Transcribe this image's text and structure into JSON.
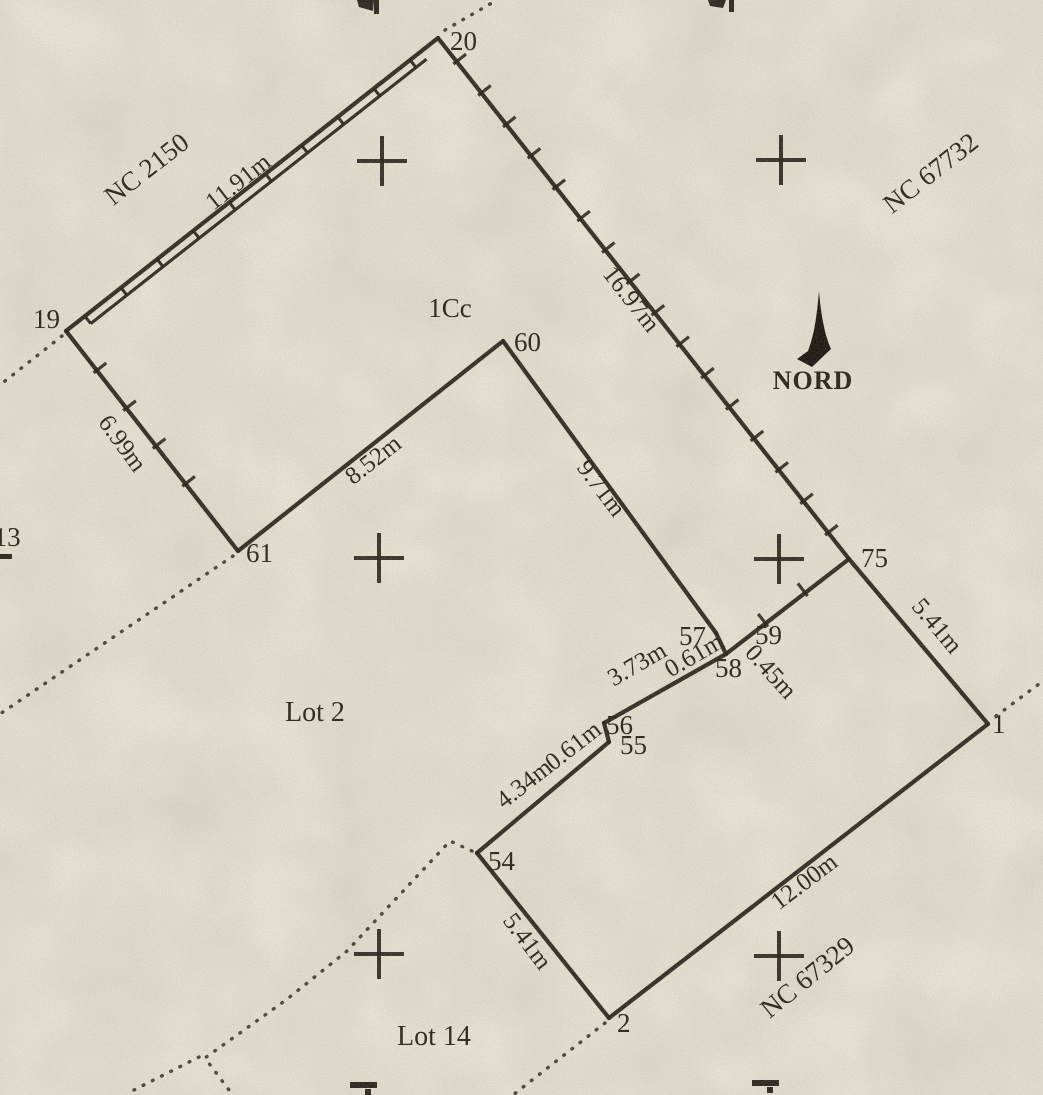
{
  "colors": {
    "paper": "#e9e5d7",
    "ink": "#241f18"
  },
  "plan": {
    "north_label": "NORD",
    "points": [
      {
        "id": "19",
        "x": 66,
        "y": 331,
        "lx": 33,
        "ly": 328
      },
      {
        "id": "20",
        "x": 438,
        "y": 38,
        "lx": 450,
        "ly": 50
      },
      {
        "id": "60",
        "x": 503,
        "y": 341,
        "lx": 514,
        "ly": 351
      },
      {
        "id": "61",
        "x": 238,
        "y": 551,
        "lx": 246,
        "ly": 562
      },
      {
        "id": "75",
        "x": 849,
        "y": 559,
        "lx": 861,
        "ly": 567
      },
      {
        "id": "59",
        "x": 740,
        "y": 640,
        "lx": 755,
        "ly": 644
      },
      {
        "id": "58",
        "x": 726,
        "y": 654,
        "lx": 715,
        "ly": 677
      },
      {
        "id": "57",
        "x": 716,
        "y": 633,
        "lx": 679,
        "ly": 645
      },
      {
        "id": "56",
        "x": 604,
        "y": 723,
        "lx": 606,
        "ly": 734
      },
      {
        "id": "55",
        "x": 609,
        "y": 742,
        "lx": 620,
        "ly": 754
      },
      {
        "id": "54",
        "x": 477,
        "y": 853,
        "lx": 488,
        "ly": 870
      },
      {
        "id": "2",
        "x": 609,
        "y": 1018,
        "lx": 617,
        "ly": 1032
      },
      {
        "id": "1",
        "x": 988,
        "y": 724,
        "lx": 992,
        "ly": 733
      }
    ],
    "edges": [
      {
        "from": "19",
        "to": "20",
        "style": "ladder"
      },
      {
        "from": "20",
        "to": "75",
        "style": "solid"
      },
      {
        "from": "19",
        "to": "61",
        "style": "solid"
      },
      {
        "from": "61",
        "to": "60",
        "style": "solid"
      },
      {
        "from": "60",
        "to": "57",
        "style": "solid"
      },
      {
        "from": "57",
        "to": "58",
        "style": "solid"
      },
      {
        "from": "58",
        "to": "56",
        "style": "solid"
      },
      {
        "from": "56",
        "to": "55",
        "style": "solid"
      },
      {
        "from": "55",
        "to": "54",
        "style": "solid"
      },
      {
        "from": "54",
        "to": "2",
        "style": "solid"
      },
      {
        "from": "2",
        "to": "1",
        "style": "solid"
      },
      {
        "from": "1",
        "to": "75",
        "style": "solid"
      },
      {
        "from": "58",
        "to": "75",
        "style": "solid"
      }
    ],
    "ticks": [
      {
        "edge": "20-75",
        "start": 30,
        "end": 640,
        "spacing": 40
      },
      {
        "edge": "19-61",
        "start": 50,
        "end": 225,
        "spacing": 48
      },
      {
        "edge": "58-75",
        "start": 50,
        "end": 110,
        "spacing": 50
      }
    ],
    "dotted": [
      {
        "id": "beyond-20",
        "pts": [
          [
            445,
            30
          ],
          [
            497,
            0
          ]
        ]
      },
      {
        "id": "beyond-19",
        "pts": [
          [
            62,
            336
          ],
          [
            0,
            385
          ]
        ]
      },
      {
        "id": "beyond-61",
        "pts": [
          [
            233,
            556
          ],
          [
            0,
            714
          ]
        ]
      },
      {
        "id": "beyond-1",
        "pts": [
          [
            996,
            716
          ],
          [
            1043,
            681
          ]
        ]
      },
      {
        "id": "beyond-2",
        "pts": [
          [
            605,
            1023
          ],
          [
            513,
            1095
          ]
        ]
      },
      {
        "id": "lot14-boundary",
        "pts": [
          [
            472,
            851
          ],
          [
            450,
            841
          ],
          [
            347,
            951
          ],
          [
            286,
            1000
          ],
          [
            205,
            1058
          ],
          [
            232,
            1094
          ]
        ]
      },
      {
        "id": "lot14-branch",
        "pts": [
          [
            199,
            1057
          ],
          [
            126,
            1094
          ]
        ]
      }
    ],
    "crosses": [
      [
        382,
        161
      ],
      [
        781,
        160
      ],
      [
        379,
        558
      ],
      [
        779,
        559
      ],
      [
        379,
        954
      ],
      [
        779,
        956
      ]
    ],
    "labels": [
      {
        "id": "nc-2150",
        "kind": "zone",
        "text": "NC 2150",
        "x": 152,
        "y": 176,
        "rot": -38
      },
      {
        "id": "m-11-91",
        "kind": "measure",
        "text": "11.91m",
        "edge": "19-20",
        "x": 243,
        "y": 188,
        "rot": -38
      },
      {
        "id": "nc-67732",
        "kind": "zone",
        "text": "NC 67732",
        "x": 936,
        "y": 180,
        "rot": -38
      },
      {
        "id": "m-16-97",
        "kind": "measure",
        "text": "16.97m",
        "edge": "20-75",
        "x": 625,
        "y": 304,
        "rot": 52
      },
      {
        "id": "m-6-99",
        "kind": "measure",
        "text": "6.99m",
        "edge": "19-61",
        "x": 116,
        "y": 448,
        "rot": 54
      },
      {
        "id": "m-8-52",
        "kind": "measure",
        "text": "8.52m",
        "edge": "61-60",
        "x": 378,
        "y": 466,
        "rot": -38
      },
      {
        "id": "m-9-71",
        "kind": "measure",
        "text": "9.71m",
        "edge": "60-57",
        "x": 595,
        "y": 493,
        "rot": 53
      },
      {
        "id": "m-5-41-a",
        "kind": "measure",
        "text": "5.41m",
        "edge": "75-1",
        "x": 931,
        "y": 631,
        "rot": 50
      },
      {
        "id": "m-0-45",
        "kind": "measure",
        "text": "0.45m",
        "edge": "58-59",
        "x": 765,
        "y": 677,
        "rot": 48
      },
      {
        "id": "m-3-73",
        "kind": "measure",
        "text": "3.73m",
        "edge": "58-56",
        "x": 641,
        "y": 671,
        "rot": -30
      },
      {
        "id": "m-0-61-a",
        "kind": "measure",
        "text": "0.61m",
        "edge": "57-58",
        "x": 698,
        "y": 662,
        "rot": -30
      },
      {
        "id": "m-0-61-b",
        "kind": "measure",
        "text": "0.61m",
        "edge": "56-55",
        "x": 578,
        "y": 752,
        "rot": -38
      },
      {
        "id": "m-4-34",
        "kind": "measure",
        "text": "4.34m",
        "edge": "55-54",
        "x": 529,
        "y": 790,
        "rot": -38
      },
      {
        "id": "m-5-41-b",
        "kind": "measure",
        "text": "5.41m",
        "edge": "54-2",
        "x": 521,
        "y": 946,
        "rot": 53
      },
      {
        "id": "m-12-00",
        "kind": "measure",
        "text": "12.00m",
        "edge": "2-1",
        "x": 809,
        "y": 888,
        "rot": -37
      },
      {
        "id": "nc-67329",
        "kind": "zone",
        "text": "NC 67329",
        "x": 813,
        "y": 984,
        "rot": -39
      },
      {
        "id": "parcel-1cc",
        "kind": "parcel",
        "text": "1Cc",
        "x": 450,
        "y": 317,
        "rot": 0
      },
      {
        "id": "lot-2",
        "kind": "lot",
        "text": "Lot 2",
        "x": 315,
        "y": 721,
        "rot": 0
      },
      {
        "id": "lot-14",
        "kind": "lot",
        "text": "Lot 14",
        "x": 434,
        "y": 1045,
        "rot": 0
      },
      {
        "id": "lot-13-cutoff",
        "kind": "zone",
        "text": "t 13",
        "x": 0,
        "y": 546,
        "rot": 0,
        "anchor": "start"
      },
      {
        "id": "north-label",
        "kind": "north",
        "text": "NORD",
        "x": 813,
        "y": 389,
        "rot": 0
      }
    ]
  }
}
